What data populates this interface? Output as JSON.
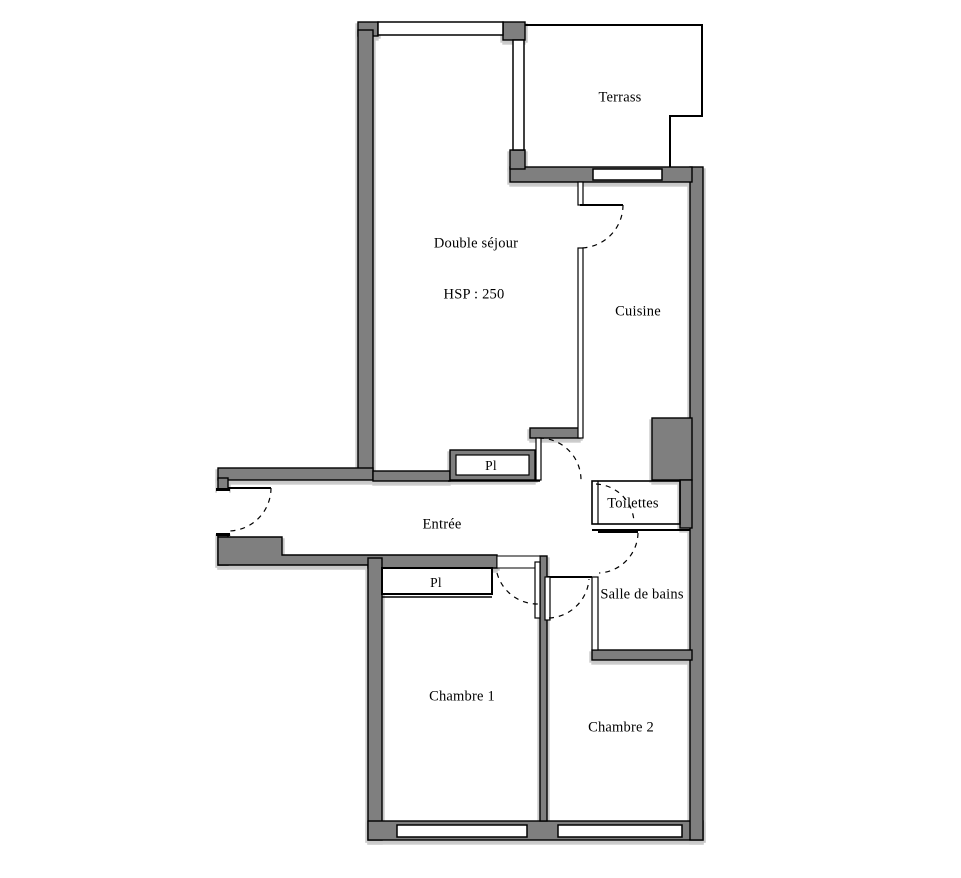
{
  "title": "Apartment floor plan",
  "colors": {
    "wall_fill": "#7f7f7f",
    "line": "#000000",
    "background": "#ffffff",
    "shadow": "#c8c8c8"
  },
  "rooms": [
    {
      "id": "terrace",
      "label": "Terrass"
    },
    {
      "id": "living-room",
      "label": "Double séjour"
    },
    {
      "id": "living-room-ceiling-height",
      "label": "HSP : 250"
    },
    {
      "id": "kitchen",
      "label": "Cuisine"
    },
    {
      "id": "closet-living",
      "label": "Pl"
    },
    {
      "id": "entry-hall",
      "label": "Entrée"
    },
    {
      "id": "toilets",
      "label": "Toilettes"
    },
    {
      "id": "bathroom",
      "label": "Salle de bains"
    },
    {
      "id": "closet-bedroom1",
      "label": "Pl"
    },
    {
      "id": "bedroom-1",
      "label": "Chambre 1"
    },
    {
      "id": "bedroom-2",
      "label": "Chambre 2"
    }
  ]
}
